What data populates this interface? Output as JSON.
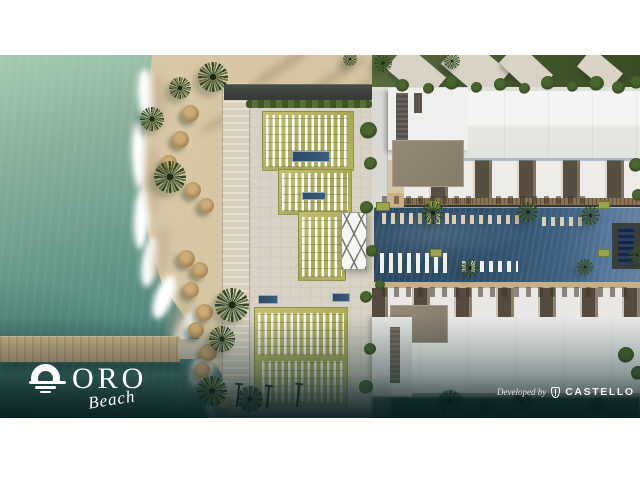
{
  "branding": {
    "logo": {
      "wordmark": "ORO",
      "script": "Beach"
    },
    "developer": {
      "prefix": "Developed by",
      "name": "CASTELLO"
    }
  },
  "palette": {
    "sea_deep": "#3a6a64",
    "sea_light": "#a6c9b0",
    "sand": "#d8c8a6",
    "lawn": "#b7b365",
    "pool": "#30506c",
    "building": "#f0f0ee",
    "taupe_roof": "#8d8170",
    "palm": "#2a4030",
    "vignette": "#071b1d"
  },
  "scene": {
    "foam": [
      [
        146,
        14,
        16,
        50,
        -4
      ],
      [
        139,
        66,
        14,
        68,
        -2
      ],
      [
        141,
        132,
        15,
        62,
        3
      ],
      [
        150,
        182,
        16,
        50,
        9
      ],
      [
        164,
        219,
        18,
        46,
        20
      ],
      [
        185,
        254,
        18,
        42,
        28
      ],
      [
        204,
        288,
        20,
        44,
        30
      ],
      [
        219,
        324,
        22,
        42,
        22
      ]
    ],
    "wet": [
      [
        158,
        20,
        14,
        56,
        -4
      ],
      [
        152,
        90,
        13,
        70,
        -2
      ],
      [
        160,
        170,
        15,
        56,
        8
      ],
      [
        180,
        240,
        16,
        48,
        24
      ],
      [
        205,
        300,
        18,
        46,
        28
      ]
    ],
    "sand_shadows": [
      [
        246,
        8,
        70,
        9,
        -34
      ],
      [
        296,
        18,
        76,
        8,
        -32
      ],
      [
        198,
        60,
        54,
        7,
        -30
      ],
      [
        330,
        30,
        60,
        7,
        -33
      ]
    ],
    "lawns": [
      [
        262,
        56,
        92,
        60
      ],
      [
        278,
        114,
        74,
        46
      ],
      [
        298,
        156,
        48,
        70
      ],
      [
        254,
        252,
        94,
        100
      ]
    ],
    "lounger_grids": [
      [
        266,
        60,
        82,
        52
      ],
      [
        282,
        118,
        66,
        38
      ],
      [
        302,
        162,
        40,
        60
      ],
      [
        258,
        258,
        86,
        42
      ],
      [
        262,
        306,
        82,
        42
      ]
    ],
    "minipools": [
      [
        292,
        96,
        38,
        11
      ],
      [
        302,
        137,
        24,
        8
      ],
      [
        258,
        240,
        20,
        9
      ],
      [
        332,
        238,
        18,
        9
      ]
    ],
    "pool_rows": [
      [
        382,
        158,
        70,
        11,
        ""
      ],
      [
        452,
        160,
        72,
        9,
        ""
      ],
      [
        380,
        198,
        68,
        20,
        "white"
      ],
      [
        462,
        206,
        56,
        11,
        "white"
      ],
      [
        542,
        162,
        44,
        9,
        ""
      ]
    ],
    "deck_rows": [
      [
        382,
        141,
        96,
        8
      ],
      [
        496,
        141,
        92,
        8
      ],
      [
        382,
        232,
        250,
        10
      ]
    ],
    "green_mats": [
      [
        376,
        147,
        14,
        9
      ],
      [
        428,
        146,
        12,
        8
      ],
      [
        598,
        146,
        12,
        8
      ],
      [
        430,
        194,
        12,
        8
      ],
      [
        598,
        194,
        12,
        8
      ]
    ],
    "roofslabs": [
      [
        390,
        2,
        52,
        32,
        40
      ],
      [
        446,
        -6,
        58,
        38,
        40
      ],
      [
        502,
        0,
        48,
        28,
        43
      ],
      [
        580,
        3,
        40,
        24,
        40
      ]
    ],
    "palms": [
      [
        213,
        22,
        30,
        ""
      ],
      [
        180,
        33,
        22,
        ""
      ],
      [
        152,
        64,
        24,
        ""
      ],
      [
        170,
        122,
        32,
        ""
      ],
      [
        232,
        250,
        34,
        ""
      ],
      [
        222,
        284,
        26,
        ""
      ],
      [
        212,
        336,
        30,
        ""
      ],
      [
        383,
        8,
        18,
        ""
      ],
      [
        452,
        6,
        16,
        ""
      ],
      [
        350,
        4,
        14,
        ""
      ],
      [
        433,
        158,
        22,
        ""
      ],
      [
        528,
        157,
        20,
        ""
      ],
      [
        590,
        160,
        19,
        ""
      ],
      [
        470,
        213,
        18,
        ""
      ],
      [
        585,
        212,
        16,
        ""
      ],
      [
        637,
        200,
        16,
        ""
      ],
      [
        250,
        344,
        26,
        "dark"
      ],
      [
        450,
        347,
        24,
        "dark"
      ],
      [
        487,
        352,
        18,
        "dark"
      ],
      [
        522,
        347,
        20,
        "dark"
      ],
      [
        598,
        352,
        18,
        "dark"
      ]
    ],
    "umbrellas": [
      [
        190,
        58,
        17
      ],
      [
        180,
        84,
        17
      ],
      [
        169,
        108,
        16
      ],
      [
        193,
        135,
        16
      ],
      [
        206,
        150,
        15
      ],
      [
        186,
        203,
        17
      ],
      [
        200,
        215,
        16
      ],
      [
        191,
        235,
        16
      ],
      [
        204,
        257,
        17
      ],
      [
        196,
        275,
        16
      ],
      [
        208,
        297,
        17
      ],
      [
        202,
        315,
        16
      ],
      [
        214,
        335,
        17
      ],
      [
        224,
        349,
        16
      ]
    ],
    "bushes": [
      [
        368,
        75,
        17
      ],
      [
        370,
        108,
        13
      ],
      [
        366,
        152,
        13
      ],
      [
        372,
        196,
        12
      ],
      [
        366,
        242,
        12
      ],
      [
        370,
        294,
        12
      ],
      [
        366,
        332,
        14
      ],
      [
        402,
        30,
        13
      ],
      [
        428,
        33,
        11
      ],
      [
        452,
        28,
        14
      ],
      [
        476,
        32,
        11
      ],
      [
        500,
        29,
        13
      ],
      [
        524,
        33,
        11
      ],
      [
        548,
        28,
        14
      ],
      [
        572,
        31,
        11
      ],
      [
        596,
        28,
        15
      ],
      [
        618,
        32,
        13
      ],
      [
        636,
        27,
        13
      ],
      [
        636,
        110,
        14
      ],
      [
        638,
        140,
        12
      ],
      [
        626,
        300,
        16
      ],
      [
        638,
        318,
        14
      ],
      [
        380,
        230,
        10
      ]
    ],
    "poles": [
      [
        237,
        330
      ],
      [
        267,
        332
      ],
      [
        297,
        330
      ]
    ]
  }
}
